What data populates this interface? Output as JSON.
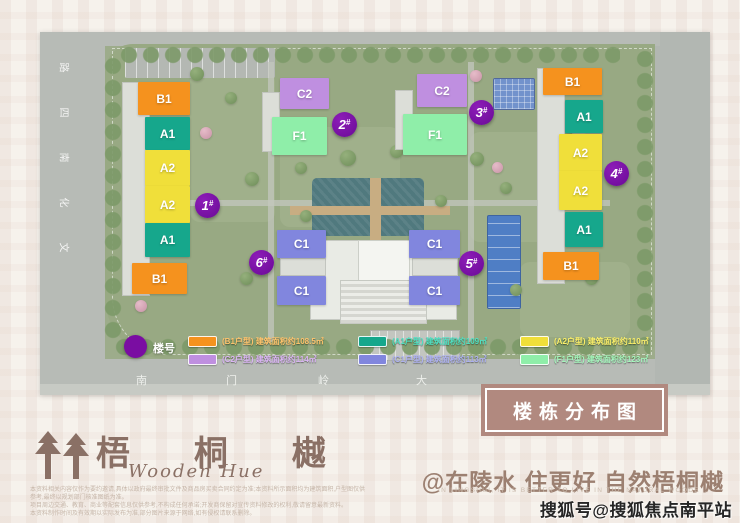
{
  "map": {
    "left_road_chars": [
      "路",
      "四",
      "南",
      "化",
      "文"
    ],
    "bottom_road_chars": [
      "南",
      "门",
      "岭",
      "大"
    ],
    "marker_label": "楼号",
    "badge_suffix": "#",
    "buildings": [
      {
        "badge": "1",
        "blocks": [
          "B1",
          "A1",
          "A2",
          "A2",
          "A1",
          "B1"
        ]
      },
      {
        "badge": "2",
        "blocks": [
          "C2",
          "F1"
        ]
      },
      {
        "badge": "3",
        "blocks": [
          "C2",
          "F1"
        ]
      },
      {
        "badge": "4",
        "blocks": [
          "B1",
          "A1",
          "A2",
          "A2",
          "A1",
          "B1"
        ]
      },
      {
        "badge": "5",
        "blocks": [
          "C1",
          "C1"
        ]
      },
      {
        "badge": "6",
        "blocks": [
          "C1",
          "C1"
        ]
      }
    ],
    "legend": [
      {
        "type": "B1",
        "label": "(B1户型) 建筑面积约108.5㎡"
      },
      {
        "type": "A1",
        "label": "(A1户型) 建筑面积约109㎡"
      },
      {
        "type": "A2",
        "label": "(A2户型) 建筑面积约110㎡"
      },
      {
        "type": "C2",
        "label": "(C2户型) 建筑面积约114㎡"
      },
      {
        "type": "C1",
        "label": "(C1户型) 建筑面积约113㎡"
      },
      {
        "type": "F1",
        "label": "(F1户型) 建筑面积约123㎡"
      }
    ]
  },
  "title_plate": {
    "text": "楼栋分布图"
  },
  "footer": {
    "logo_text": "梧 桐 樾",
    "logo_subtitle": "Wooden Hue",
    "tagline": "@在陵水 住更好 自然梧桐樾",
    "tagline_en": "In Lingshui, it is better to live in the natural Wooden Hue",
    "disclaimer_lines": [
      "本资料相关内容仅作为要约邀请,具体以政府最终审批文件及商品房买卖合同约定为准;本资料所示面积均为建筑面积,户型图仅供参考,最终以规划部门核准图纸为准。",
      "项目周边交通、教育、商业等配套信息仅供参考,不构成任何承诺;开发商保留对宣传资料修改的权利,敬请留意最新资料。",
      "本资料制作时间及有效期以实际发布为准,部分图片来源于网络,如有侵权请联系删除。"
    ],
    "watermark": "搜狐号@搜狐焦点南平站"
  },
  "colors": {
    "B1": "#F5921E",
    "A1": "#16A78C",
    "A2": "#F0DF3A",
    "C2": "#BF8FE0",
    "C1": "#8186DE",
    "F1": "#8FEEA9",
    "badge": "#7A0DA2",
    "plate_bg": "#B1897F",
    "brand": "#8A7065"
  }
}
